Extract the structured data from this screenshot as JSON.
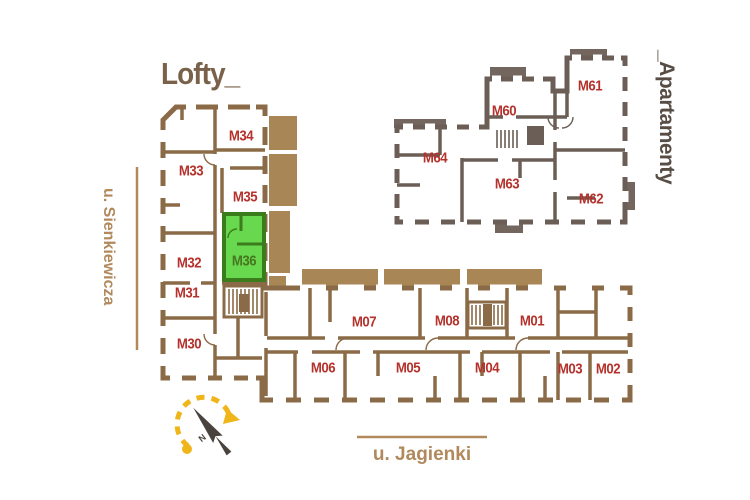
{
  "titles": {
    "lofty": "Lofty_",
    "apartamenty": "_Apartamenty"
  },
  "streets": {
    "left": {
      "name": "u. Sienkiewicza"
    },
    "bottom": {
      "name": "u. Jagienki"
    }
  },
  "compass": {
    "label": "N"
  },
  "highlighted_unit": {
    "id": "M36",
    "fill": "#68d94e",
    "wall_color": "#3b7c1c",
    "label_color": "#47761f"
  },
  "colors": {
    "lofty_wall": "#8b6b47",
    "balcony_fill": "#a98655",
    "apartamenty_wall": "#6b5e56",
    "apartamenty_balcony_fill": "#73665e",
    "unit_label": "#b5322c",
    "street_label": "#b1895c",
    "lofty_title": "#79614a",
    "apartamenty_title": "#584d45",
    "compass_arrow": "#f0b519",
    "compass_needle": "#4a423c"
  },
  "units": {
    "lofty": {
      "m30": {
        "label": "M30"
      },
      "m31": {
        "label": "M31"
      },
      "m32": {
        "label": "M32"
      },
      "m33": {
        "label": "M33"
      },
      "m34": {
        "label": "M34"
      },
      "m35": {
        "label": "M35"
      },
      "m36": {
        "label": "M36"
      }
    },
    "jagienki_wing": {
      "m01": {
        "label": "M01"
      },
      "m02": {
        "label": "M02"
      },
      "m03": {
        "label": "M03"
      },
      "m04": {
        "label": "M04"
      },
      "m05": {
        "label": "M05"
      },
      "m06": {
        "label": "M06"
      },
      "m07": {
        "label": "M07"
      },
      "m08": {
        "label": "M08"
      }
    },
    "apartamenty": {
      "m60": {
        "label": "M60"
      },
      "m61": {
        "label": "M61"
      },
      "m62": {
        "label": "M62"
      },
      "m63": {
        "label": "M63"
      },
      "m64": {
        "label": "M64"
      }
    }
  }
}
